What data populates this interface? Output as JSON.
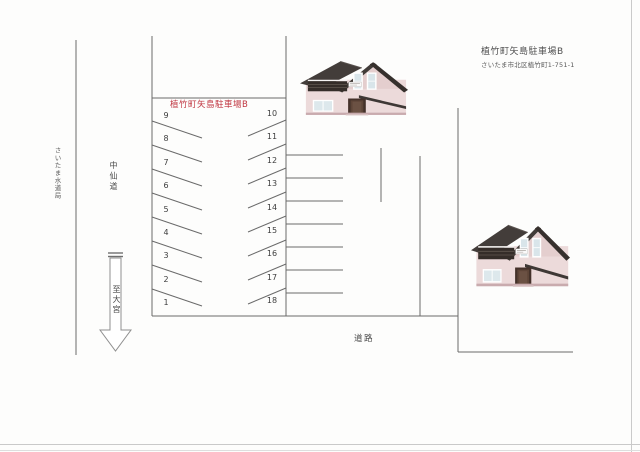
{
  "header": {
    "title": "植竹町矢島駐車場B",
    "address": "さいたま市北区植竹町1-751-1"
  },
  "diagram": {
    "title": "植竹町矢島駐車場B",
    "left_spaces": [
      "9",
      "8",
      "7",
      "6",
      "5",
      "4",
      "3",
      "2",
      "1"
    ],
    "right_spaces": [
      "10",
      "11",
      "12",
      "13",
      "14",
      "15",
      "16",
      "17",
      "18"
    ]
  },
  "labels": {
    "water_bureau": "さいたま水道局",
    "street": "中仙道",
    "to_omiya": "至大宮",
    "road": "道路"
  },
  "colors": {
    "title_red": "#c03540",
    "line_gray": "#6a6a6a",
    "arrow_outline": "#8f8f8f",
    "house_wall": "#ecdada",
    "house_roof": "#423c39",
    "house_balcony": "#352d29",
    "house_base": "#c9abae"
  }
}
